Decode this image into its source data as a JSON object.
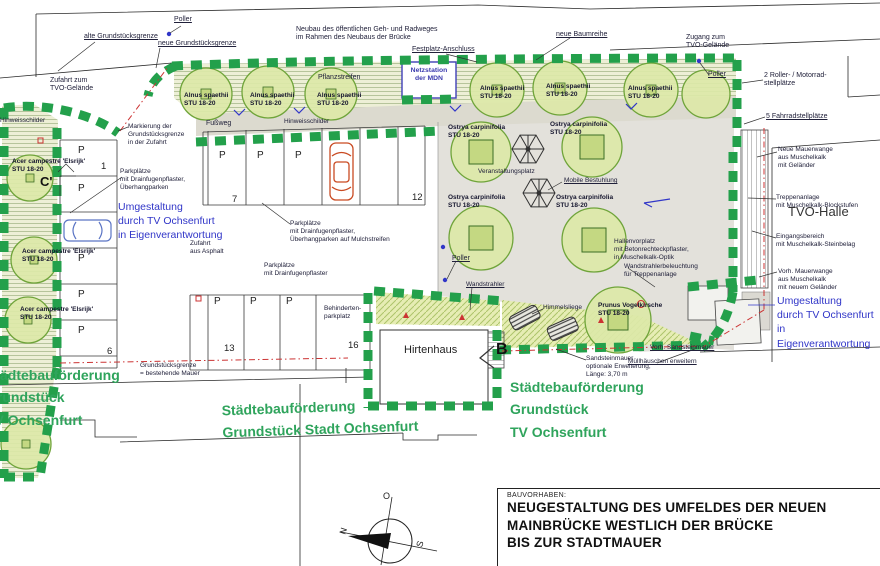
{
  "colors": {
    "hedge_green": "#23a04b",
    "canopy_green": "#dce8a8",
    "funding_text_green": "#2fa45c",
    "annotation_blue": "#3136c8",
    "boundary_red": "#cc3333",
    "plaza_gray": "#e3e1db"
  },
  "plan": {
    "netzstation": "Netzstation\nder MDN"
  },
  "markers": {
    "b": "B",
    "c": "C'"
  },
  "compass": {
    "n": "N",
    "o": "O",
    "s": "S"
  },
  "parking": {
    "stall_letter": "P",
    "numbers": [
      "1",
      "7",
      "12",
      "6",
      "13",
      "16"
    ]
  },
  "title_block": {
    "kicker": "BAUVORHABEN:",
    "line1": "NEUGESTALTUNG DES UMFELDES DER NEUEN",
    "line2": "MAINBRÜCKE WESTLICH DER BRÜCKE",
    "line3": "BIS ZUR STADTMAUER"
  },
  "labels": [
    {
      "id": "poller-top",
      "text": "Poller"
    },
    {
      "id": "alte-grenze",
      "text": "alte Grundstücksgrenze"
    },
    {
      "id": "neue-grenze",
      "text": "neue Grundstücksgrenze"
    },
    {
      "id": "neubau-radweg",
      "text": "Neubau des öffentlichen Geh- und Radweges\nim Rahmen des Neubaus der Brücke"
    },
    {
      "id": "festplatz-anschluss",
      "text": "Festplatz-Anschluss"
    },
    {
      "id": "neue-baumreihe",
      "text": "neue Baumreihe"
    },
    {
      "id": "zugang-tvo",
      "text": "Zugang zum\nTVO-Gelände"
    },
    {
      "id": "poller-right",
      "text": "Poller"
    },
    {
      "id": "roller-stellplaetze",
      "text": "2 Roller- / Motorrad-\nstellplätze"
    },
    {
      "id": "fahrradstellplaetze",
      "text": "5 Fahrradstellplätze"
    },
    {
      "id": "pflanzstreifen",
      "text": "Pflanzstreifen"
    },
    {
      "id": "alnus-1",
      "text": "Alnus spaethii\nSTU 18-20"
    },
    {
      "id": "alnus-2",
      "text": "Alnus spaethii\nSTU 18-20"
    },
    {
      "id": "alnus-3",
      "text": "Alnus spaethii\nSTU 18-20"
    },
    {
      "id": "alnus-4",
      "text": "Alnus spaethii\nSTU 18-20"
    },
    {
      "id": "alnus-5",
      "text": "Alnus spaethii\nSTU 18-20"
    },
    {
      "id": "alnus-6",
      "text": "Alnus spaethii\nSTU 18-20"
    },
    {
      "id": "zufahrt-tvo",
      "text": "Zufahrt zum\nTVO-Gelände"
    },
    {
      "id": "markierung",
      "text": "Markierung der\nGrundstücksgrenze\nin der Zufahrt"
    },
    {
      "id": "fussweg",
      "text": "Fußweg"
    },
    {
      "id": "hinweisschilder",
      "text": "Hinweisschilder"
    },
    {
      "id": "hinweisschilder-links",
      "text": "Hinweisschilder"
    },
    {
      "id": "ostrya-1",
      "text": "Ostrya carpinifolia\nSTU 18-20"
    },
    {
      "id": "ostrya-2",
      "text": "Ostrya carpinifolia\nSTU 18-20"
    },
    {
      "id": "ostrya-3",
      "text": "Ostrya carpinifolia\nSTU 18-20"
    },
    {
      "id": "ostrya-4",
      "text": "Ostrya carpinifolia\nSTU 18-20"
    },
    {
      "id": "veranstaltungsplatz",
      "text": "Veranstaltungsplatz"
    },
    {
      "id": "mobile-bestuhlung",
      "text": "Mobile Bestuhlung"
    },
    {
      "id": "hallenvorplatz",
      "text": "Hallenvorplatz\nmit Betonrechteckpflaster,\nin Muschelkalk-Optik"
    },
    {
      "id": "tvo-halle",
      "text": "TVO-Halle"
    },
    {
      "id": "neue-mauerwange",
      "text": "Neue Mauerwange\naus Muschelkalk\nmit Geländer"
    },
    {
      "id": "treppenanlage",
      "text": "Treppenanlage\nmit Muschelkalk-Blockstufen"
    },
    {
      "id": "eingangsbereich",
      "text": "Eingangsbereich\nmit Muschelkalk-Steinbelag"
    },
    {
      "id": "vorh-mauerwange",
      "text": "Vorh. Mauerwange\naus Muschelkalk\nmit neuem Geländer"
    },
    {
      "id": "umgestaltung-rechts",
      "text": "Umgestaltung\ndurch TV Ochsenfurt\nin Eigenverantwortung"
    },
    {
      "id": "wandbeleuchtung",
      "text": "Wandstrahlerbeleuchtung\nfür Treppenanlage"
    },
    {
      "id": "poller-mitte",
      "text": "Poller"
    },
    {
      "id": "wandstrahler",
      "text": "Wandstrahler"
    },
    {
      "id": "hirtenhaus",
      "text": "Hirtenhaus"
    },
    {
      "id": "behindertenparkplatz",
      "text": "Behinderten-\nparkplatz"
    },
    {
      "id": "himmelsliege",
      "text": "Himmelsliege"
    },
    {
      "id": "prunus",
      "text": "Prunus Vogelkirsche\nSTU 18-20"
    },
    {
      "id": "vorh-sandsteinmauer",
      "text": "Vorh. Sandsteinmauer"
    },
    {
      "id": "sandsteinmauer-optional",
      "text": "Sandsteinmauer\noptionale Erweiterung,\nLänge: 3,70 m"
    },
    {
      "id": "muellhaeuschen",
      "text": "Müllhäuschen erweitern"
    },
    {
      "id": "staedtebau-tv-rechts",
      "text": "Städtebauförderung\nGrundstück\nTV Ochsenfurt"
    },
    {
      "id": "staedtebau-stadt",
      "text": "Städtebauförderung\nGrundstück Stadt Ochsenfurt"
    },
    {
      "id": "staedtebau-tv-links",
      "text": "Städtebauförderung\nGrundstück\nTV Ochsenfurt"
    },
    {
      "id": "umgestaltung-links",
      "text": "Umgestaltung\ndurch TV Ochsenfurt\nin Eigenverantwortung"
    },
    {
      "id": "parkplaetze-ueberhang",
      "text": "Parkplätze\nmit Drainfugenpflaster,\nÜberhangparken"
    },
    {
      "id": "parkplaetze-mulch",
      "text": "Parkplätze\nmit Drainfugenpflaster,\nÜberhangparken auf Mulchstreifen"
    },
    {
      "id": "parkplaetze-drain",
      "text": "Parkplätze\nmit Drainfugenpflaster"
    },
    {
      "id": "zufahrt-asphalt",
      "text": "Zufahrt\naus Asphalt"
    },
    {
      "id": "grundstuecksgrenze-mauer",
      "text": "Grundstücksgrenze\n= bestehende Mauer"
    },
    {
      "id": "acer-1",
      "text": "Acer campestre 'Elsrijk'\nSTU 18-20"
    },
    {
      "id": "acer-2",
      "text": "Acer campestre 'Elsrijk'\nSTU 18-20"
    },
    {
      "id": "acer-3",
      "text": "Acer campestre 'Elsrijk'\nSTU 18-20"
    }
  ]
}
